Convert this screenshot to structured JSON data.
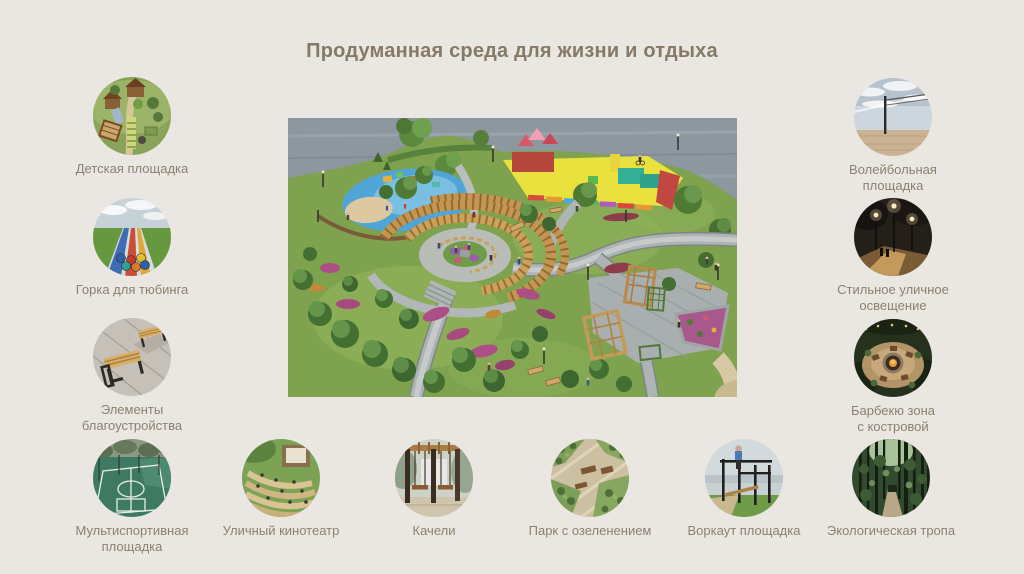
{
  "slide": {
    "title": "Продуманная среда для жизни и отдыха",
    "background_color": "#EAE7E2",
    "title_color": "#867A66",
    "label_color": "#8C8070"
  },
  "features": {
    "left": [
      {
        "label": "Детская площадка",
        "icon": "playground-photo"
      },
      {
        "label": "Горка для тюбинга",
        "icon": "tubing-hill-photo"
      },
      {
        "label": "Элементы благоустройства",
        "icon": "benches-photo"
      },
      {
        "label": "Мультиспортивная площадка",
        "icon": "multisport-court-photo"
      }
    ],
    "bottom": [
      {
        "label": "Уличный кинотеатр",
        "icon": "open-air-cinema-photo"
      },
      {
        "label": "Качели",
        "icon": "swings-photo"
      },
      {
        "label": "Парк с озеленением",
        "icon": "landscaped-park-photo"
      },
      {
        "label": "Воркаут площадка",
        "icon": "workout-ground-photo"
      },
      {
        "label": "Экологическая тропа",
        "icon": "eco-trail-photo"
      }
    ],
    "right": [
      {
        "label": "Волейбольная площадка",
        "icon": "volleyball-court-photo"
      },
      {
        "label": "Стильное уличное освещение",
        "icon": "street-lighting-photo"
      },
      {
        "label": "Барбекю зона с костровой",
        "icon": "bbq-fire-pit-photo"
      }
    ]
  },
  "central_image": {
    "kind": "park-aerial-render"
  }
}
